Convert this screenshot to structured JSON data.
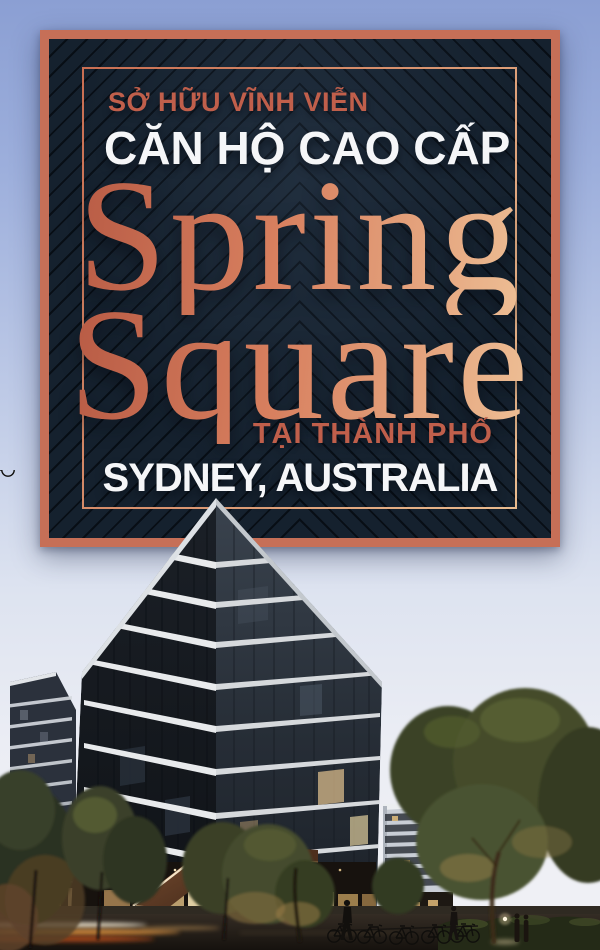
{
  "poster": {
    "card": {
      "tagline_top": "SỞ HỮU VĨNH VIỄN",
      "subtitle": "CĂN HỘ CAO CẤP",
      "brand_line1": "Spring",
      "brand_line2": "Square",
      "tagline_bottom": "TẠI THÀNH PHỐ",
      "location": "SYDNEY, AUSTRALIA"
    },
    "scene_label": "apartment-towers-street-photo"
  },
  "colors": {
    "sky_top": "#8b9fd3",
    "sky_bottom": "#eff0f5",
    "card_bg": "#15212e",
    "card_border": "#c66f57",
    "accent_salmon": "#c05f4b",
    "text_white": "#f5f6f8",
    "brand_gradient_start": "#b75a44",
    "brand_gradient_mid": "#d8805f",
    "brand_gradient_end": "#eec096",
    "frame_gradient_start": "#c96e52",
    "frame_gradient_end": "#e9bb8e"
  }
}
